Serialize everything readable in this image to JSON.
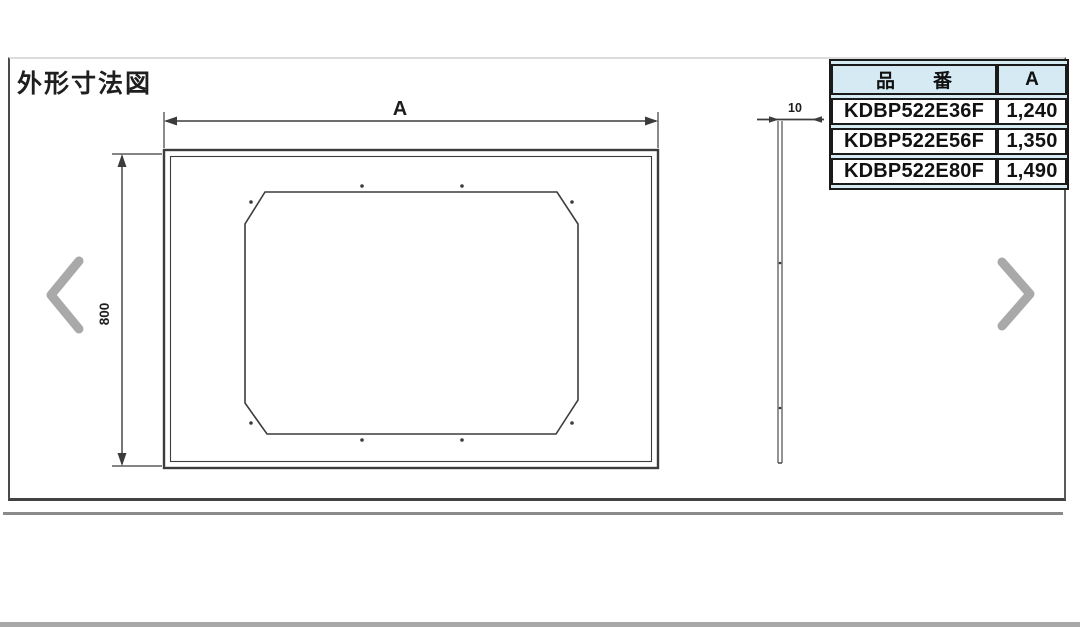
{
  "drawing": {
    "title": "外形寸法図",
    "dims": {
      "width_label": "A",
      "height_label": "800",
      "thickness_label": "10"
    }
  },
  "parts_table": {
    "headers": {
      "part_no": "品　　番",
      "a": "A"
    },
    "rows": [
      {
        "part_no": "KDBP522E36F",
        "a": "1,240"
      },
      {
        "part_no": "KDBP522E56F",
        "a": "1,350"
      },
      {
        "part_no": "KDBP522E80F",
        "a": "1,490"
      }
    ]
  },
  "carousel": {
    "prev_label": "previous image",
    "next_label": "next image"
  },
  "colors": {
    "table_header_bg": "#d5eaf3",
    "table_border": "#1a1a1a",
    "drawing_line": "#3c3c3c",
    "chevron": "#a9a9a9",
    "frame_gray": "#8a8a8a"
  }
}
